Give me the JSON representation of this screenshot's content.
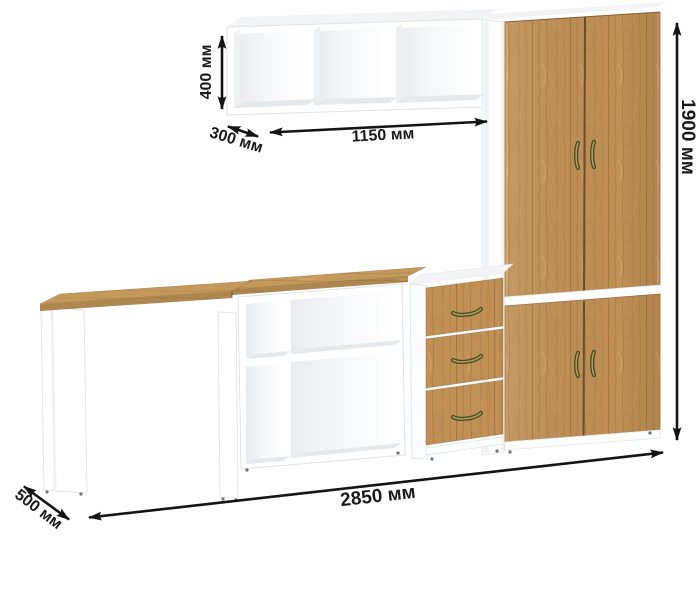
{
  "diagram": {
    "labels": {
      "shelf_height": "400 мм",
      "shelf_depth": "300 мм",
      "shelf_width": "1150 мм",
      "total_height": "1900 мм",
      "total_width": "2850 мм",
      "desk_depth": "500 мм"
    },
    "colors": {
      "background": "#ffffff",
      "furniture_white": "#ffffff",
      "wood": "#c09055",
      "dimension_arrow": "#141414",
      "handle_brass": "#8a894a"
    }
  }
}
